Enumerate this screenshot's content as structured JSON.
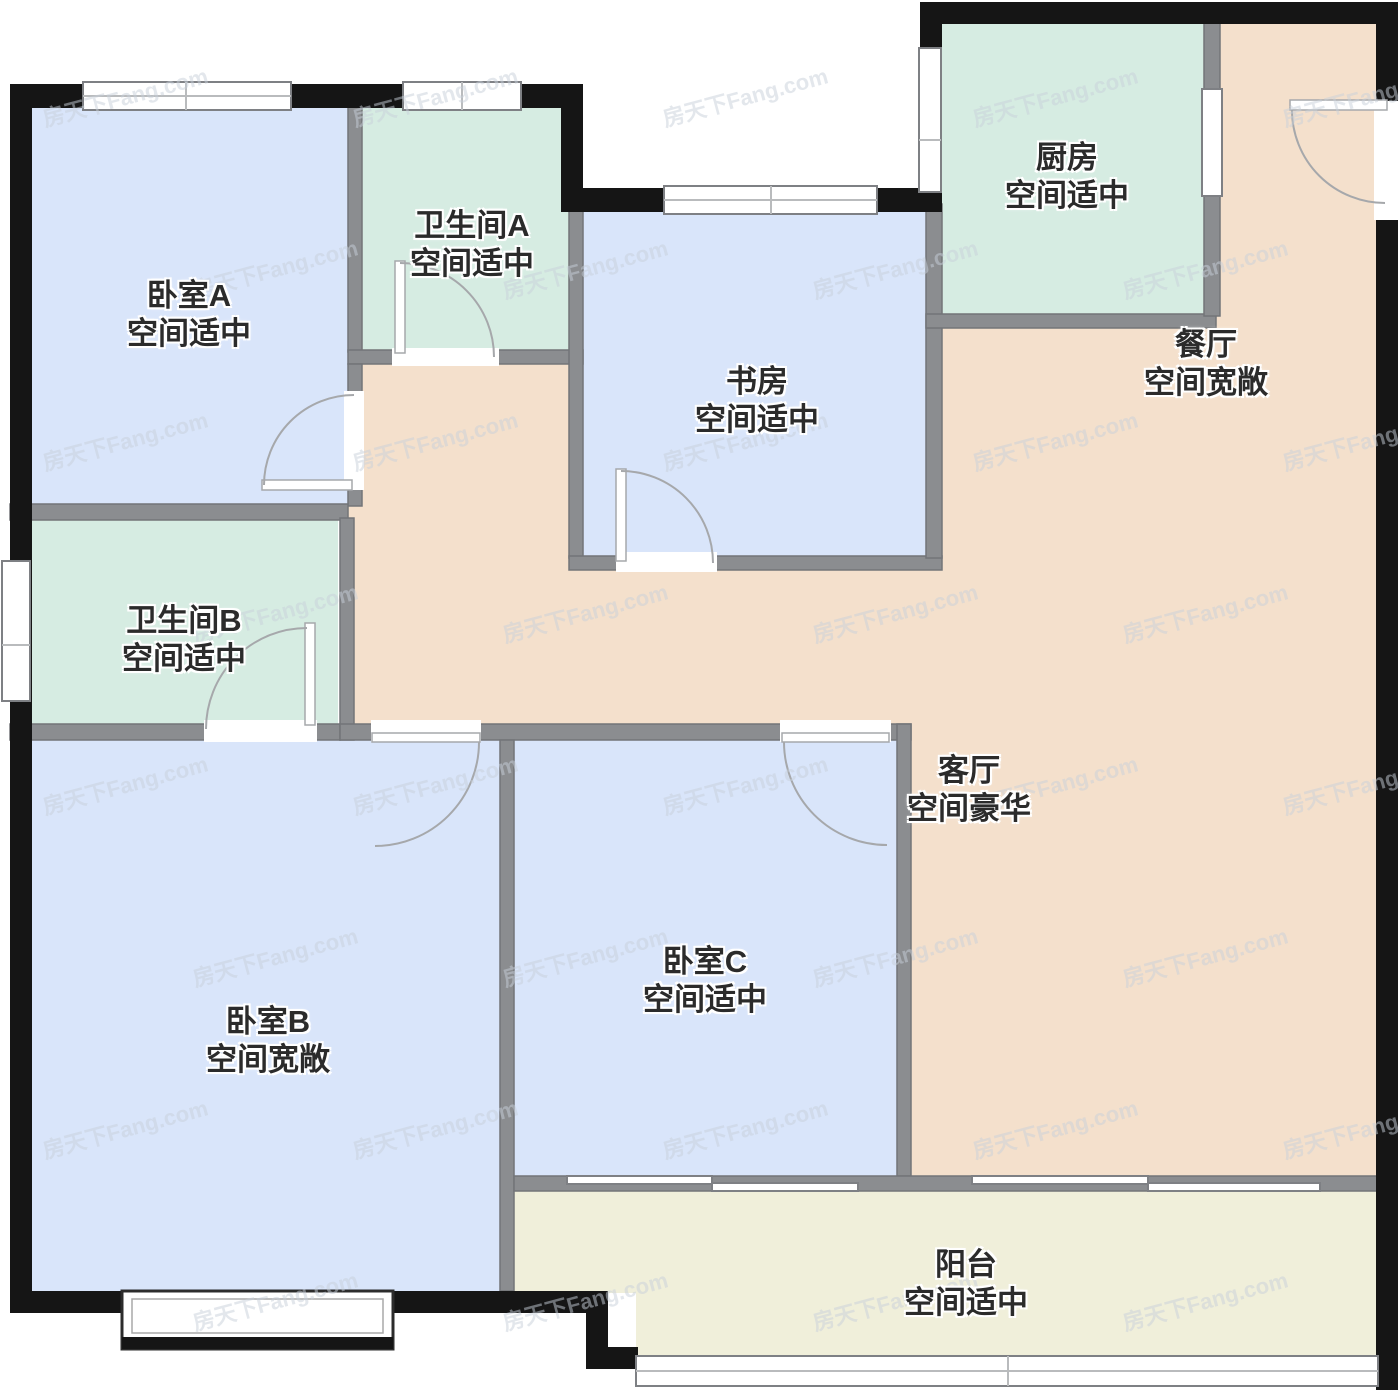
{
  "plan": {
    "watermark_text": "房天下Fang.com"
  },
  "colors": {
    "bedroom_floor": "#d9e5fa",
    "wet_floor": "#d6ece2",
    "hall_floor": "#f4e0cc",
    "balcony_floor": "#f0efda",
    "exterior_wall": "#151515",
    "interior_wall": "#8b8d90",
    "interior_wall_edge": "#737578",
    "window_edge": "#7e8084",
    "door_stroke": "#a6a8ab",
    "label_text": "#2b2b2b"
  },
  "rooms": {
    "bedroom_a": {
      "name": "卧室A",
      "descriptor": "空间适中"
    },
    "bathroom_a": {
      "name": "卫生间A",
      "descriptor": "空间适中"
    },
    "study": {
      "name": "书房",
      "descriptor": "空间适中"
    },
    "kitchen": {
      "name": "厨房",
      "descriptor": "空间适中"
    },
    "dining": {
      "name": "餐厅",
      "descriptor": "空间宽敞"
    },
    "bathroom_b": {
      "name": "卫生间B",
      "descriptor": "空间适中"
    },
    "living": {
      "name": "客厅",
      "descriptor": "空间豪华"
    },
    "bedroom_b": {
      "name": "卧室B",
      "descriptor": "空间宽敞"
    },
    "bedroom_c": {
      "name": "卧室C",
      "descriptor": "空间适中"
    },
    "balcony": {
      "name": "阳台",
      "descriptor": "空间适中"
    }
  }
}
